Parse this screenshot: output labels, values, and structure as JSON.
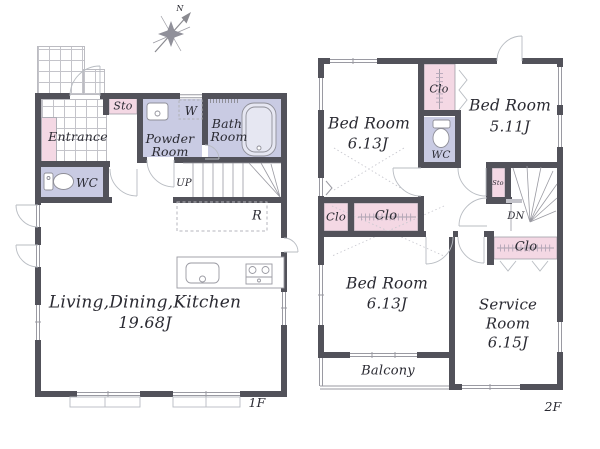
{
  "meta": {
    "compass_north": "N"
  },
  "palette": {
    "wall": "#52525a",
    "room_lavender": "#c9cbe3",
    "room_pink": "#f4d8e4"
  },
  "floor1": {
    "label": "1F",
    "rooms": {
      "sto": "Sto",
      "entrance": "Entrance",
      "wc": "WC",
      "powder_line1": "Powder",
      "powder_line2": "Room",
      "washer": "W",
      "bath_line1": "Bath",
      "bath_line2": "Room",
      "stairs_up": "UP",
      "fridge": "R",
      "ldk_name": "Living,Dining,Kitchen",
      "ldk_area": "19.68J"
    }
  },
  "floor2": {
    "label": "2F",
    "rooms": {
      "bedroom_nw_name": "Bed Room",
      "bedroom_nw_area": "6.13J",
      "closet_n": "Clo",
      "bedroom_ne_name": "Bed Room",
      "bedroom_ne_area": "5.11J",
      "wc": "WC",
      "storage": "Sto",
      "stairs_down": "DN",
      "closet_hall_small": "Clo",
      "closet_hall_large": "Clo",
      "closet_e": "Clo",
      "bedroom_s_name": "Bed Room",
      "bedroom_s_area": "6.13J",
      "service_line1": "Service",
      "service_line2": "Room",
      "service_area": "6.15J",
      "balcony": "Balcony"
    }
  }
}
